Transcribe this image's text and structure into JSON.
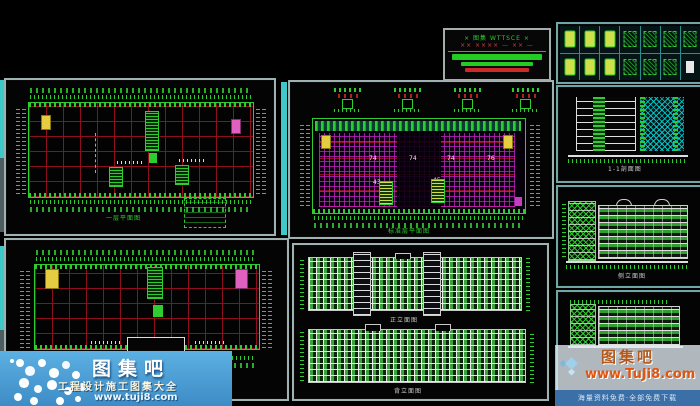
{
  "colors": {
    "cad_green": "#2ecc2e",
    "grid_red": "#960e1e",
    "hatch_magenta": "#c424c4",
    "cyan_bar": "#3fc8c8",
    "panel_border": "#9fb2b2",
    "yellow_block": "#e6cc40",
    "magenta_block": "#e060c0",
    "bar_green": "#22cc22",
    "bar_red": "#cc2a2a",
    "wm_blue": "#4d9fd6",
    "wm_bar_blue": "#3a6fa8",
    "wm_orange_title": "#b25a1e",
    "wm_orange_url": "#e05510"
  },
  "title_block": {
    "line1": "× 图集 WTTSCE ×",
    "line2": "×× ×××× — ×× —"
  },
  "panels": {
    "plan1": {
      "label": "一层平面图"
    },
    "plan2": {
      "label": "二层平面图"
    },
    "plan3": {
      "label": "标准层平面图",
      "numbers": [
        "74",
        "74",
        "74",
        "76",
        "43",
        "45"
      ]
    },
    "elev_main": {
      "label1": "正立面图",
      "label2": "背立面图"
    },
    "section": {
      "label": "1-1剖面图"
    },
    "side1": {
      "label": "侧立面图"
    },
    "side2": {
      "label": "侧立面图"
    }
  },
  "watermark_left": {
    "title": "图集吧",
    "subtitle": "工程设计施工图集大全",
    "url": "www.tuji8.com"
  },
  "watermark_right": {
    "title": "图集吧",
    "url": "www.TuJi8.com",
    "banner": "海量资料免费·全部免费下载"
  }
}
